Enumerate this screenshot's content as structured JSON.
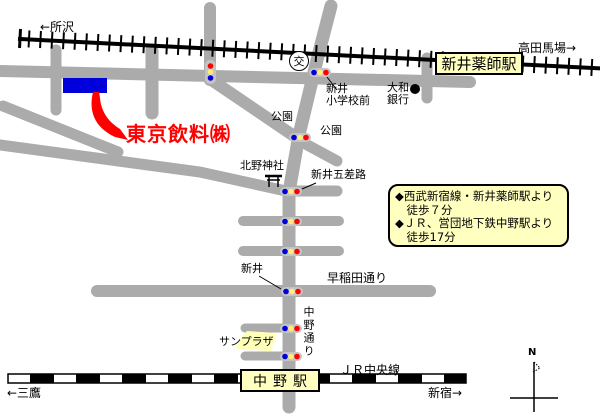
{
  "map": {
    "company": {
      "name": "東京飲料㈱"
    },
    "labels": {
      "tokorozawa": "←所沢",
      "takadanobaba": "高田馬場→",
      "araiYakushiStation": "新井薬師駅",
      "koban": "交",
      "araiElementary": "新井\n小学校前",
      "daiwaBank": "大和\n銀行",
      "park1": "公園",
      "park2": "公園",
      "kitanoShrine": "北野神社",
      "araiGosaro": "新井五差路",
      "arai": "新井",
      "wasedaDori": "早稲田通り",
      "nakanoDori": "中野通り",
      "sunplaza": "サンプラザ",
      "jrChuoLine": "ＪＲ中央線",
      "nakanoStation": "中野駅",
      "mitaka": "←三鷹",
      "shinjuku": "新宿→",
      "compassNorth": "N"
    },
    "info_box": {
      "text": "◆西武新宿線・新井薬師駅より\n　徒歩７分\n◆ＪＲ、営団地下鉄中野駅より\n　徒歩17分"
    },
    "colors": {
      "road": "#ababab",
      "company_building": "#0000dd",
      "company_text": "#ff0000",
      "arrow": "#ff0000",
      "station_box_fill": "#ffffc0",
      "sunplaza_fill": "#ffffb8",
      "signal_pill": "#c4c4c4",
      "signal_blue": "#0000dd",
      "signal_yellow": "#ffee77",
      "signal_red": "#ff0000"
    }
  }
}
